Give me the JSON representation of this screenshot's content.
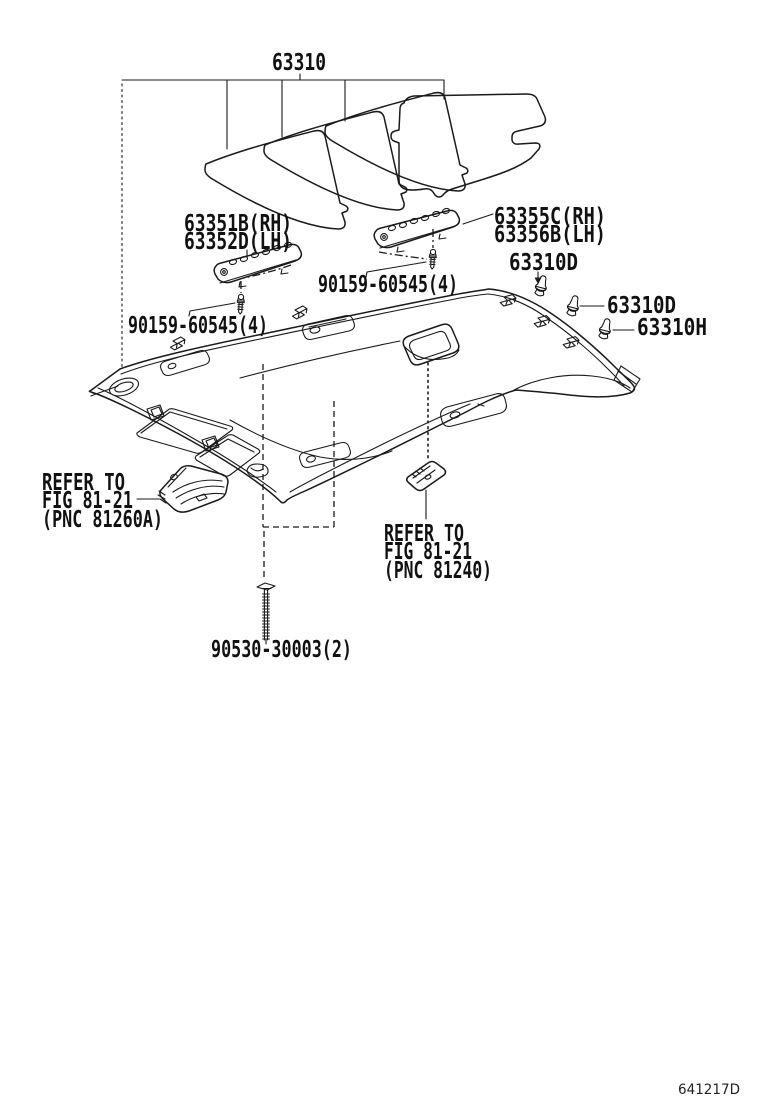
{
  "diagram": {
    "main_part": "63310",
    "labels": {
      "rail_left_line1": "63351B(RH)",
      "rail_left_line2": "63352D(LH)",
      "rail_right_line1": "63355C(RH)",
      "rail_right_line2": "63356B(LH)",
      "rail_screw_left": "90159-60545(4)",
      "rail_screw_right": "90159-60545(4)",
      "clip_top": "63310D",
      "clip_mid": "63310D",
      "clip_side": "63310H",
      "console_screw": "90530-30003(2)",
      "figure_code": "641217D"
    },
    "references": {
      "console": [
        "REFER TO",
        "FIG 81-21",
        "(PNC 81260A)"
      ],
      "lamp": [
        "REFER TO",
        "FIG 81-21",
        "(PNC 81240)"
      ]
    }
  }
}
